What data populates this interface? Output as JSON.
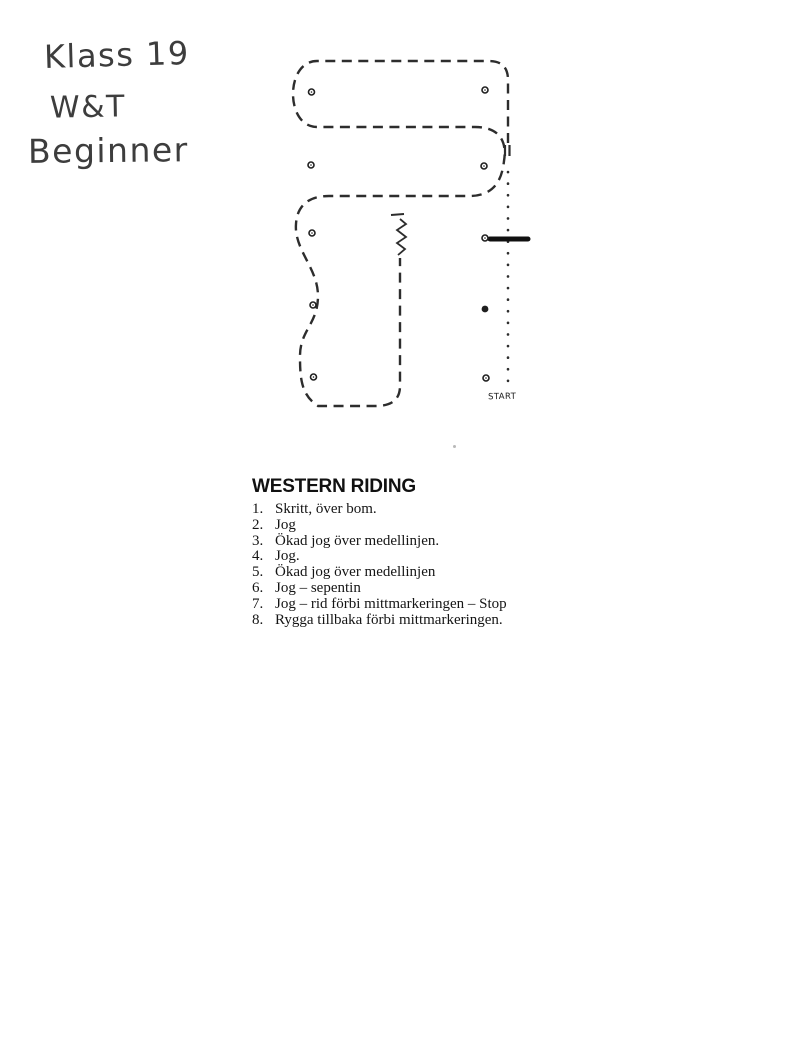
{
  "page": {
    "background": "#ffffff",
    "ink_color": "#2d2d2d"
  },
  "handwriting": {
    "line1": "Klass 19",
    "line2": "W&T",
    "line3": "Beginner"
  },
  "diagram": {
    "start_label": "START",
    "cone_markers": {
      "left_column": 5,
      "right_column": 5
    },
    "elements": {
      "riding_path": "dashed serpentine pattern path",
      "entry_line": "dotted start line",
      "ground_pole": "bold walk-over pole",
      "back_up_marker": "zigzag stop/back marker",
      "transition_ticks": "double tick marks"
    }
  },
  "instructions": {
    "title": "WESTERN RIDING",
    "items": [
      {
        "n": "1.",
        "t": "Skritt, över bom."
      },
      {
        "n": "2.",
        "t": "Jog"
      },
      {
        "n": "3.",
        "t": "Ökad jog över medellinjen."
      },
      {
        "n": "4.",
        "t": "Jog."
      },
      {
        "n": "5.",
        "t": "Ökad jog över medellinjen"
      },
      {
        "n": "6.",
        "t": "Jog – sepentin"
      },
      {
        "n": "7.",
        "t": "Jog – rid förbi mittmarkeringen – Stop"
      },
      {
        "n": "8.",
        "t": "Rygga tillbaka förbi mittmarkeringen."
      }
    ]
  }
}
